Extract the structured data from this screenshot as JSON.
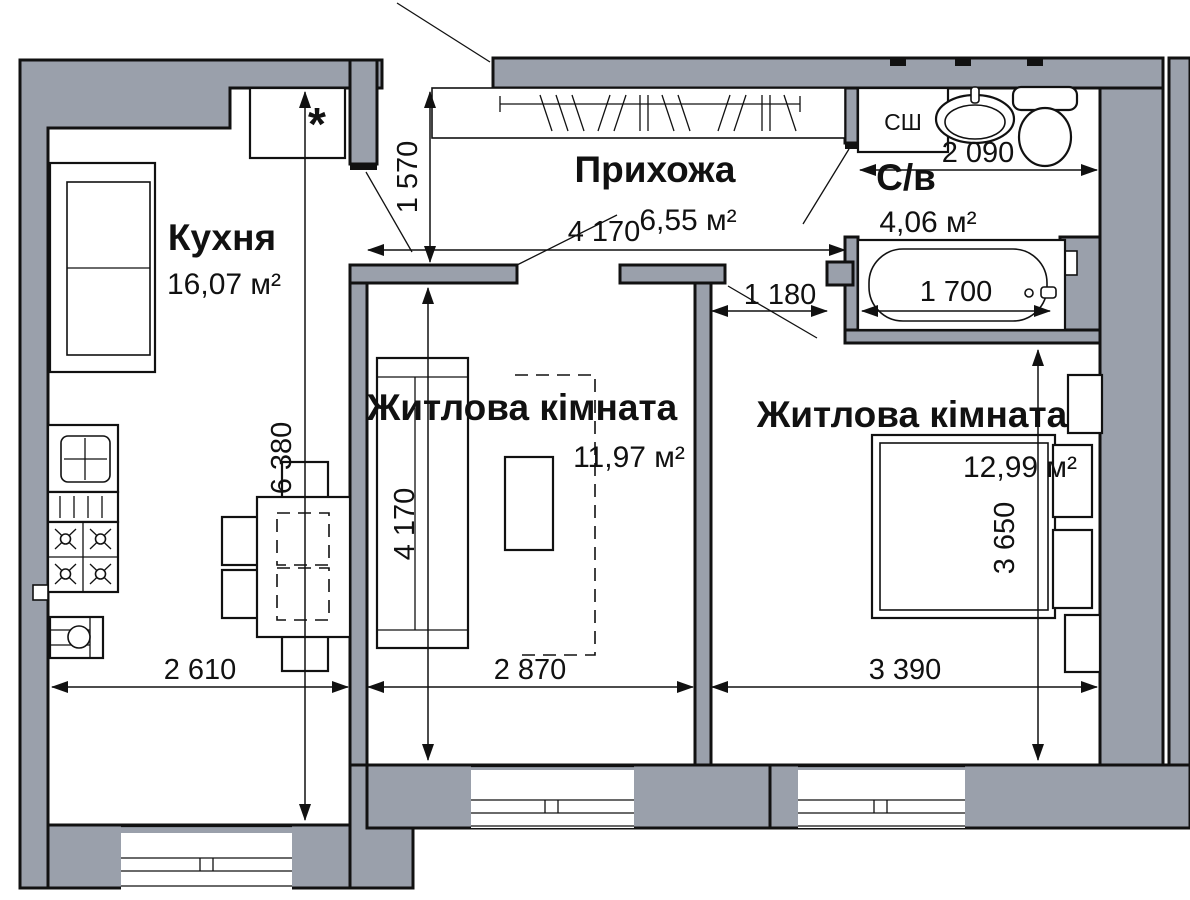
{
  "rooms": {
    "kitchen": {
      "name": "Кухня",
      "area": "16,07 м²"
    },
    "hallway": {
      "name": "Прихожа",
      "area": "6,55 м²"
    },
    "bathroom": {
      "name": "С/в",
      "area": "4,06 м²"
    },
    "living_room_1": {
      "name": "Житлова кімната",
      "area": "11,97 м²"
    },
    "living_room_2": {
      "name": "Житлова кімната",
      "area": "12,99 м²"
    }
  },
  "dimensions": {
    "hallway_height": "1 570",
    "hallway_width": "4 170",
    "bathroom_width": "2 090",
    "bathtub_length": "1 700",
    "bedroom_entry_width": "1 180",
    "kitchen_depth": "6 380",
    "living1_depth": "4 170",
    "living2_depth": "3 650",
    "kitchen_width": "2 610",
    "living1_width": "2 870",
    "living2_width": "3 390"
  },
  "labels": {
    "duct_cabinet": "СШ",
    "closet_mark": "*"
  },
  "colors": {
    "wall_fill": "#9aa0ab",
    "outline": "#111111",
    "background": "#ffffff"
  }
}
